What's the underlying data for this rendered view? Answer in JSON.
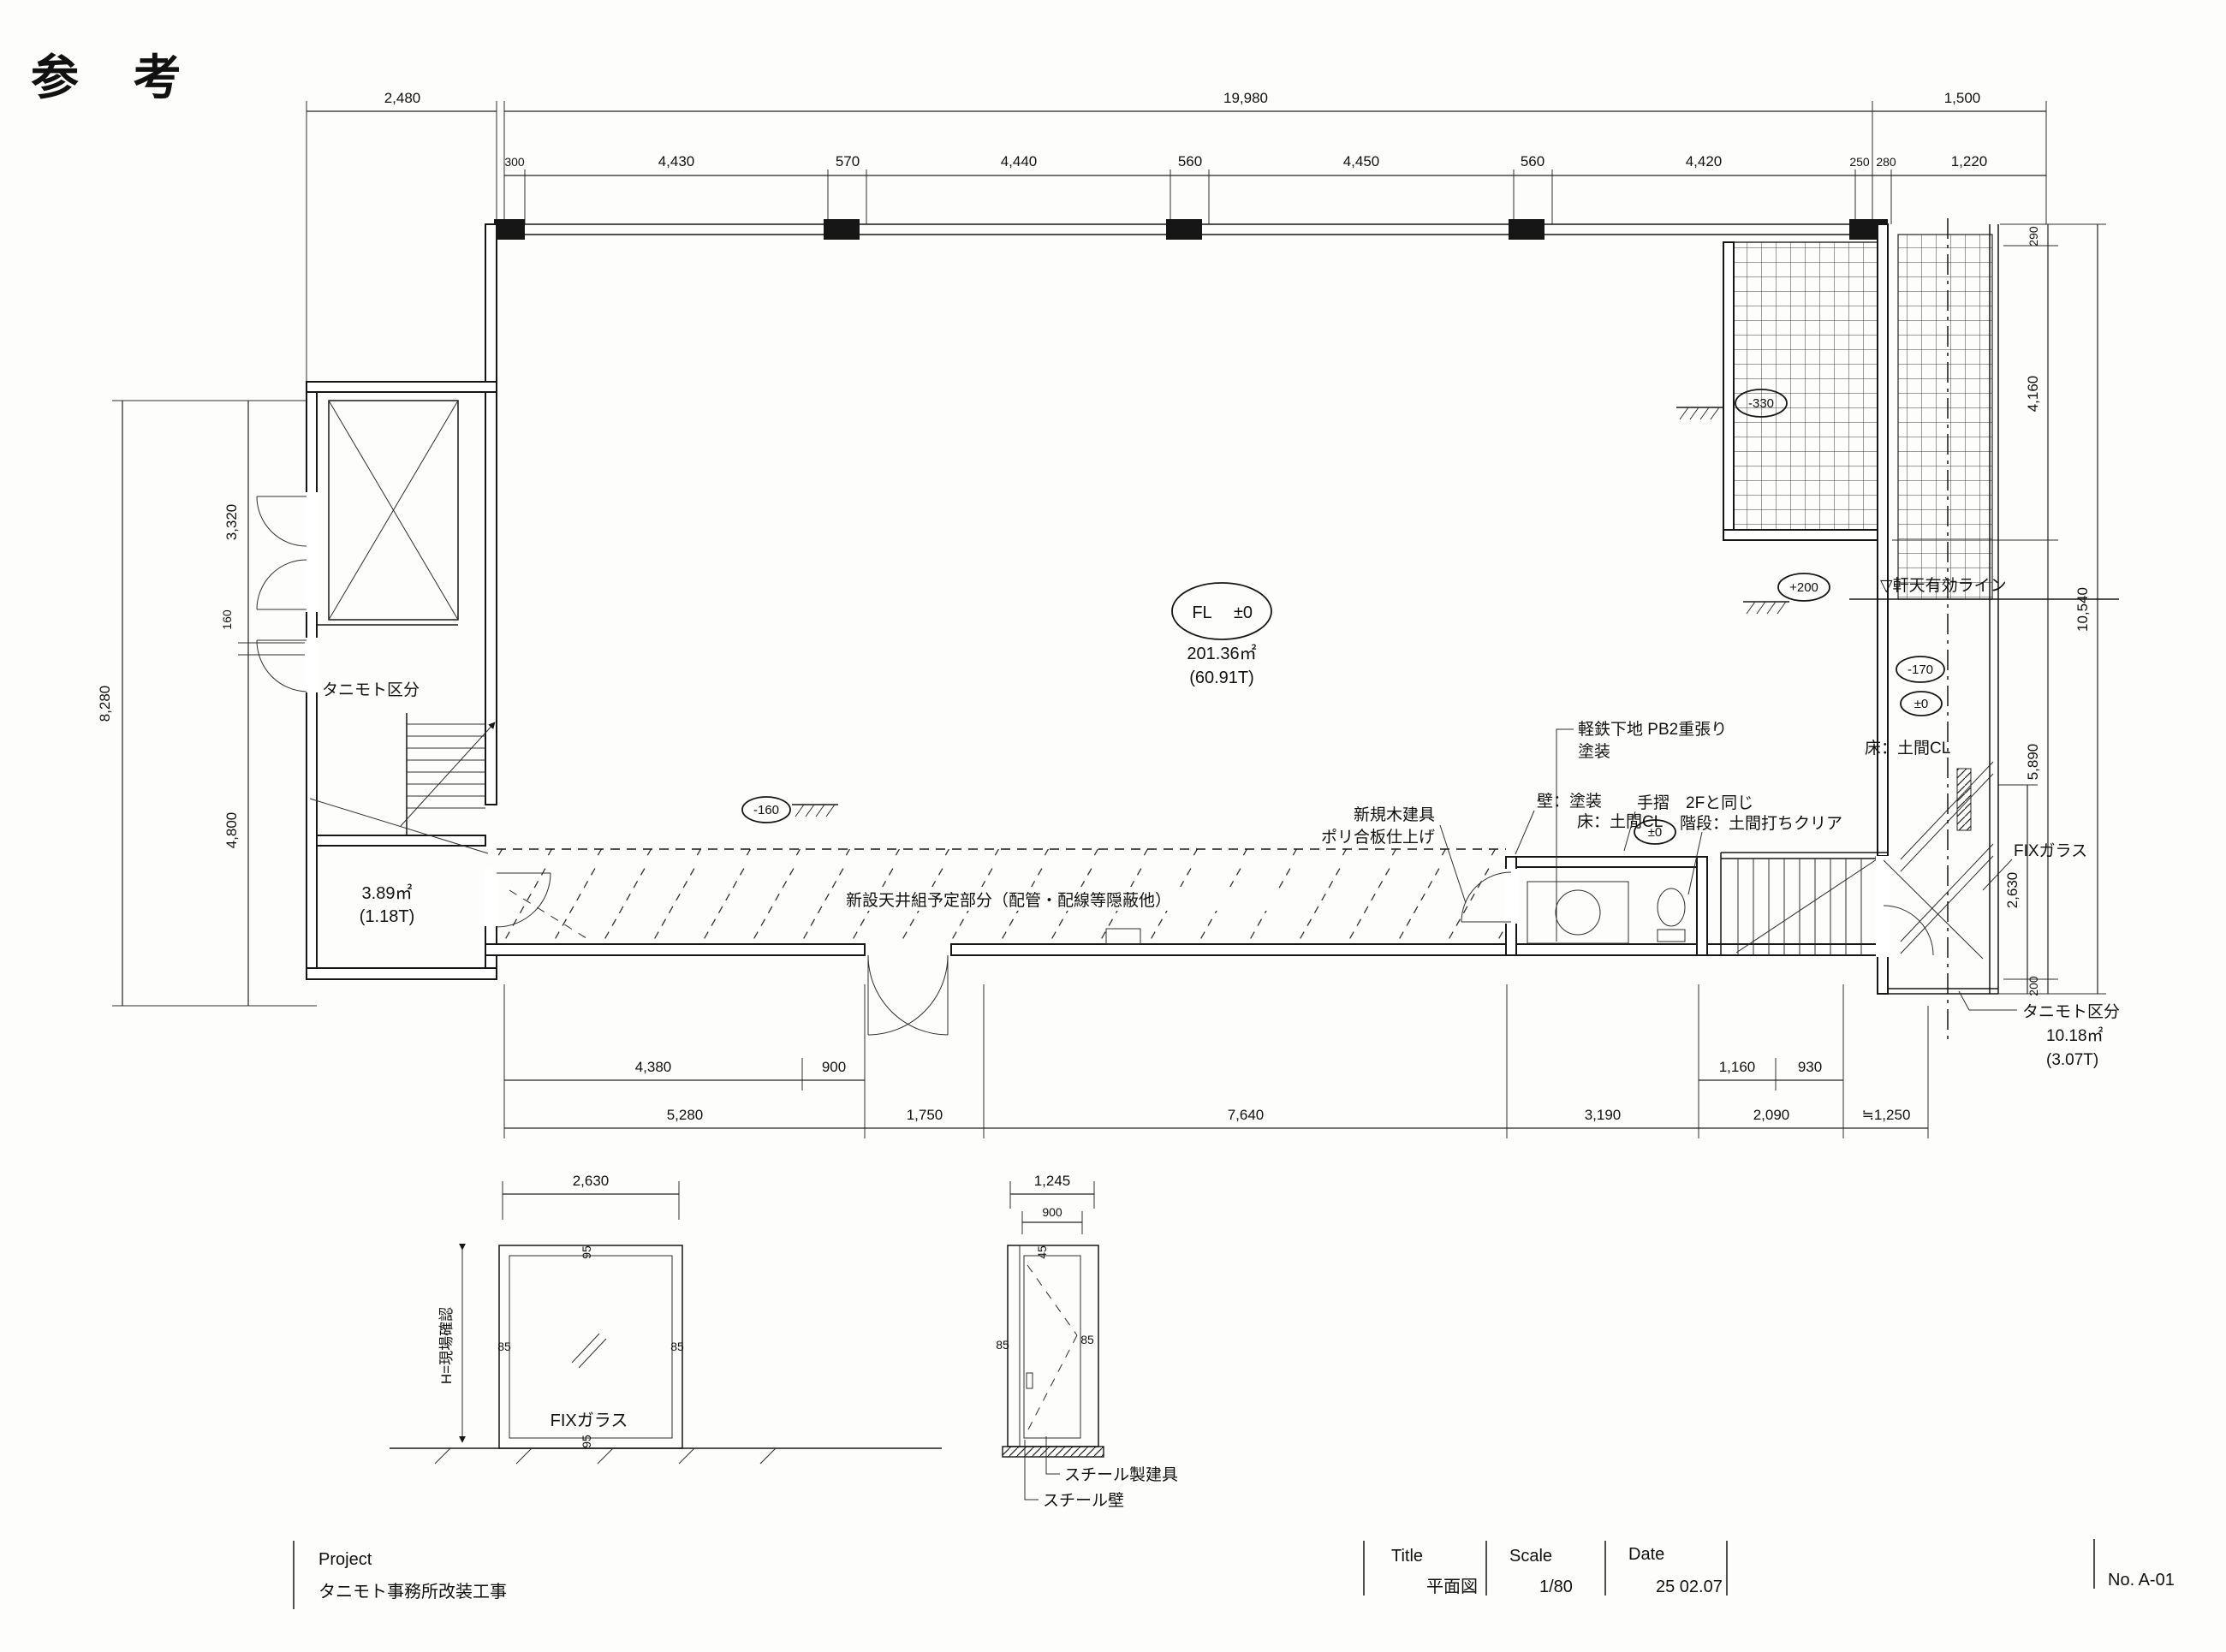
{
  "drawing": {
    "ref_mark": "参 考",
    "plan": {
      "fl_prefix": "FL",
      "fl_level": "±0",
      "area": "201.36㎡",
      "area_tsubo": "(60.91T)",
      "tanimoto_left": "タニモト区分",
      "small_area": "3.89㎡",
      "small_area_tsubo": "(1.18T)",
      "ceiling_note": "新設天井組予定部分（配管・配線等隠蔽他）",
      "wall_base_1": "軽鉄下地 PB2重張り",
      "wall_base_2": "塗装",
      "new_door_1": "新規木建具",
      "new_door_2": "ポリ合板仕上げ",
      "wall_paint": "壁：塗装",
      "floor_cl_a": "床：土間CL",
      "handrail": "手摺　2Fと同じ",
      "stair_finish": "階段：土間打ちクリア",
      "floor_cl_b": "床：土間CL",
      "eave_line": "▽軒天有効ライン",
      "fix_glass": "FIXガラス",
      "tanimoto_right": "タニモト区分",
      "tanimoto_right_area": "10.18㎡",
      "tanimoto_right_tsubo": "(3.07T)",
      "levels": {
        "approach": "-330",
        "entry": "+200",
        "terrace": "-170",
        "terrace_fl": "±0",
        "stair_fl": "±0",
        "left_door": "-160"
      }
    },
    "dims": {
      "top": {
        "left": "2,480",
        "overall": "19,980",
        "right": "1,500",
        "sub": [
          "300",
          "4,430",
          "570",
          "4,440",
          "560",
          "4,450",
          "560",
          "4,420",
          "250",
          "280",
          "1,220"
        ]
      },
      "left": {
        "overall": "8,280",
        "sub": [
          "3,320",
          "160",
          "4,800"
        ]
      },
      "right": {
        "overall": "10,540",
        "sub": [
          "290",
          "4,160",
          "5,890",
          "200"
        ],
        "fix_width": "2,630"
      },
      "bottom": {
        "sub": [
          "4,380",
          "900",
          "1,160",
          "930"
        ],
        "main": [
          "5,280",
          "1,750",
          "7,640",
          "3,190",
          "2,090",
          "≒1,250"
        ]
      }
    },
    "details": {
      "fix": {
        "width": "2,630",
        "height_note": "H=現場確認",
        "jamb_left": "85",
        "jamb_right": "85",
        "head": "95",
        "sill": "95",
        "label": "FIXガラス"
      },
      "door": {
        "overall": "1,245",
        "opening": "900",
        "jamb_left": "85",
        "jamb_right": "85",
        "head": "45",
        "label_leaf": "スチール製建具",
        "label_wall": "スチール壁"
      }
    },
    "title_block": {
      "project_label": "Project",
      "project": "タニモト事務所改装工事",
      "title_label": "Title",
      "title": "平面図",
      "scale_label": "Scale",
      "scale": "1/80",
      "date_label": "Date",
      "date": "25 02.07",
      "sheet_no": "No. A-01"
    }
  }
}
